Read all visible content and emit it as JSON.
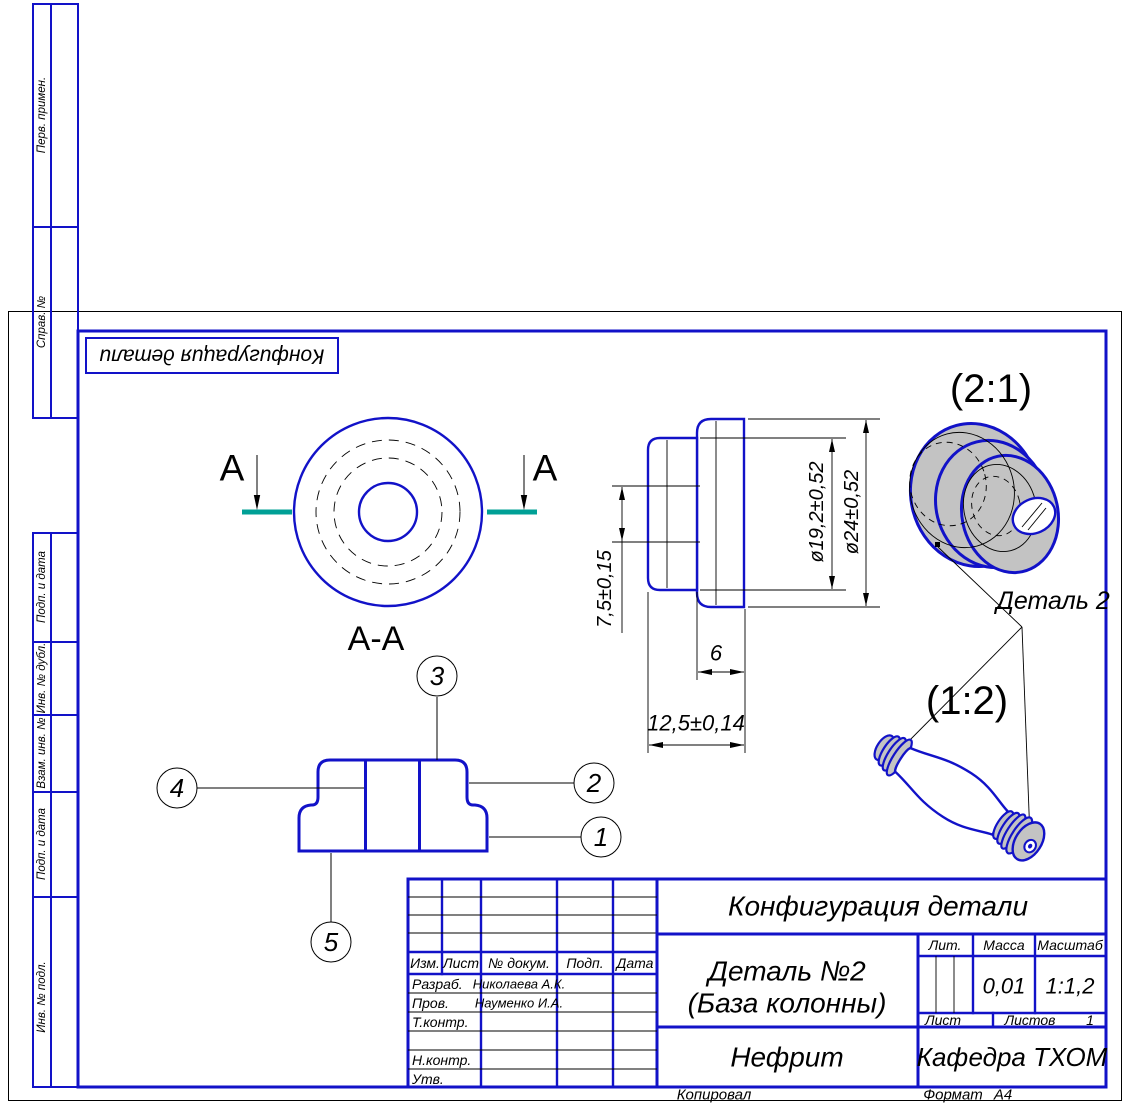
{
  "colors": {
    "line_blue": "#1212c8",
    "section_plane_teal": "#00a096",
    "solid_gray": "#c3c3c3"
  },
  "stamp": {
    "rotated_title": "Конфигурация детали"
  },
  "margin_columns": {
    "top": [
      {
        "label": "Перв. примен."
      },
      {
        "label": "Справ. №"
      }
    ],
    "bottom": [
      {
        "label": "Подп. и дата"
      },
      {
        "label": "Инв. № дубл."
      },
      {
        "label": "Взам. инв. №"
      },
      {
        "label": "Подп. и дата"
      },
      {
        "label": "Инв. № подл."
      }
    ]
  },
  "views": {
    "section_mark_letter": "А",
    "section_title": "А-А",
    "balloons": [
      "1",
      "2",
      "3",
      "4",
      "5"
    ],
    "dimensions": {
      "height": "7,5±0,15",
      "d_inner": "ø19,2±0,52",
      "d_outer": "ø24±0,52",
      "width_top": "6",
      "width_total": "12,5±0,14"
    },
    "iso_scale": "(2:1)",
    "column_scale": "(1:2)",
    "detail_callout": "Деталь 2"
  },
  "title_block": {
    "doc_title": "Конфигурация детали",
    "part_name": "Деталь №2",
    "part_name2": "(База колонны)",
    "material": "Нефрит",
    "department": "Кафедра ТХОМ",
    "lit_label": "Лит.",
    "mass_label": "Масса",
    "scale_label": "Масштаб",
    "mass_value": "0,01",
    "scale_value": "1:1,2",
    "sheet_label": "Лист",
    "sheets_label": "Листов",
    "sheets_value": "1",
    "columns": {
      "izm": "Изм.",
      "list": "Лист",
      "doc": "№ докум.",
      "sign": "Подп.",
      "date": "Дата"
    },
    "roles": {
      "developer": "Разраб.",
      "checker": "Пров.",
      "tcontrol": "Т.контр.",
      "ncontrol": "Н.контр.",
      "approver": "Утв."
    },
    "names": {
      "developer": "Николаева А.К.",
      "checker": "Науменко И.А."
    }
  },
  "footer": {
    "copied": "Копировал",
    "format_label": "Формат",
    "format_value": "А4"
  }
}
